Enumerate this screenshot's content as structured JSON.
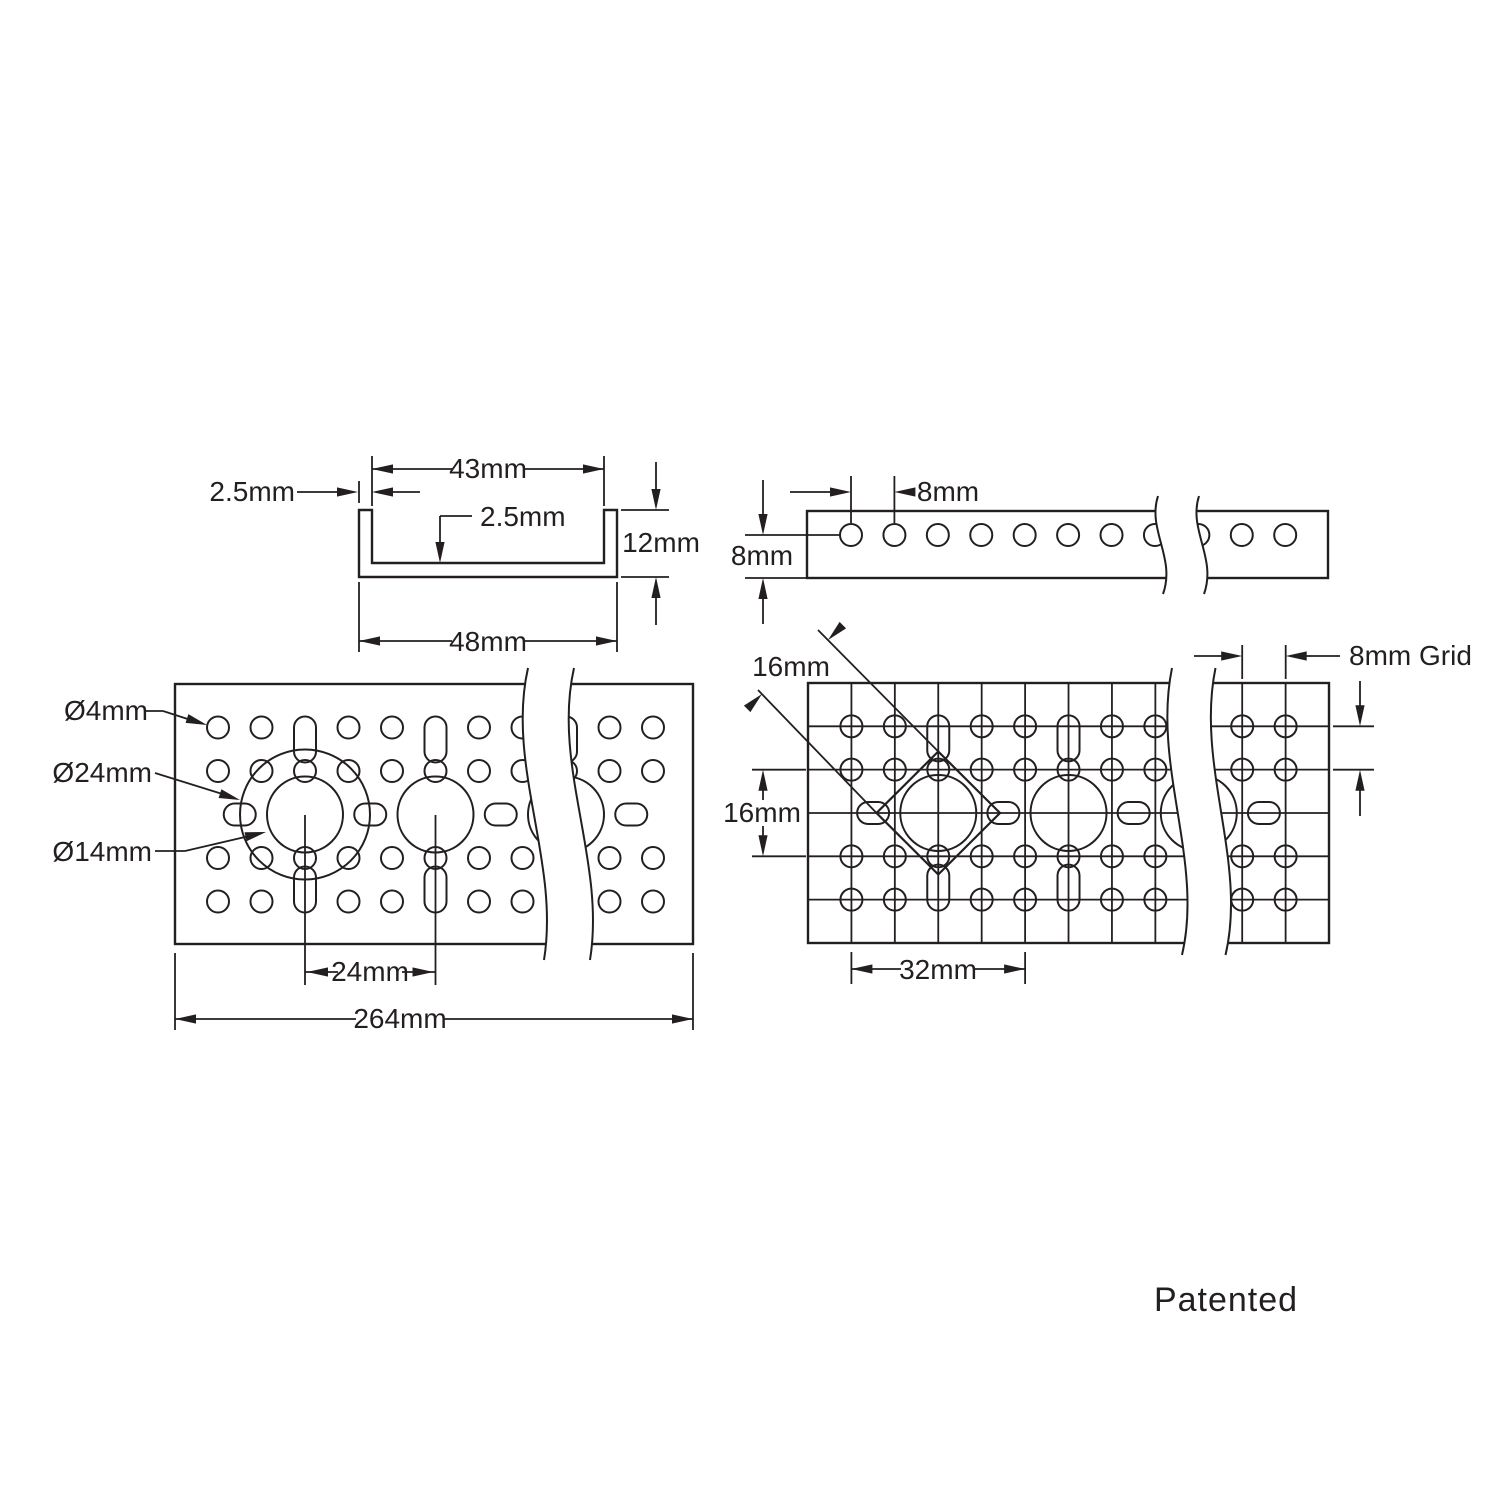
{
  "colors": {
    "ink": "#231f20",
    "paper": "#ffffff"
  },
  "views": {
    "section": {
      "title": "channel cross section",
      "inner_width": "43mm",
      "wall_thickness": "2.5mm",
      "floor_thickness": "2.5mm",
      "height": "12mm",
      "outer_width": "48mm"
    },
    "side": {
      "title": "side profile",
      "hole_pitch": "8mm",
      "edge_distance": "8mm"
    },
    "face": {
      "title": "face hole pattern",
      "small_hole_dia": "Ø4mm",
      "large_bore_dia": "Ø24mm",
      "center_hole_dia": "Ø14mm",
      "large_hole_pitch": "24mm",
      "overall_length": "264mm"
    },
    "grid": {
      "title": "8mm grid pattern",
      "diamond_size": "16mm",
      "row_span": "16mm",
      "grid_label": "8mm Grid",
      "pattern_pitch": "32mm"
    }
  },
  "footer": {
    "patent_note": "Patented"
  }
}
